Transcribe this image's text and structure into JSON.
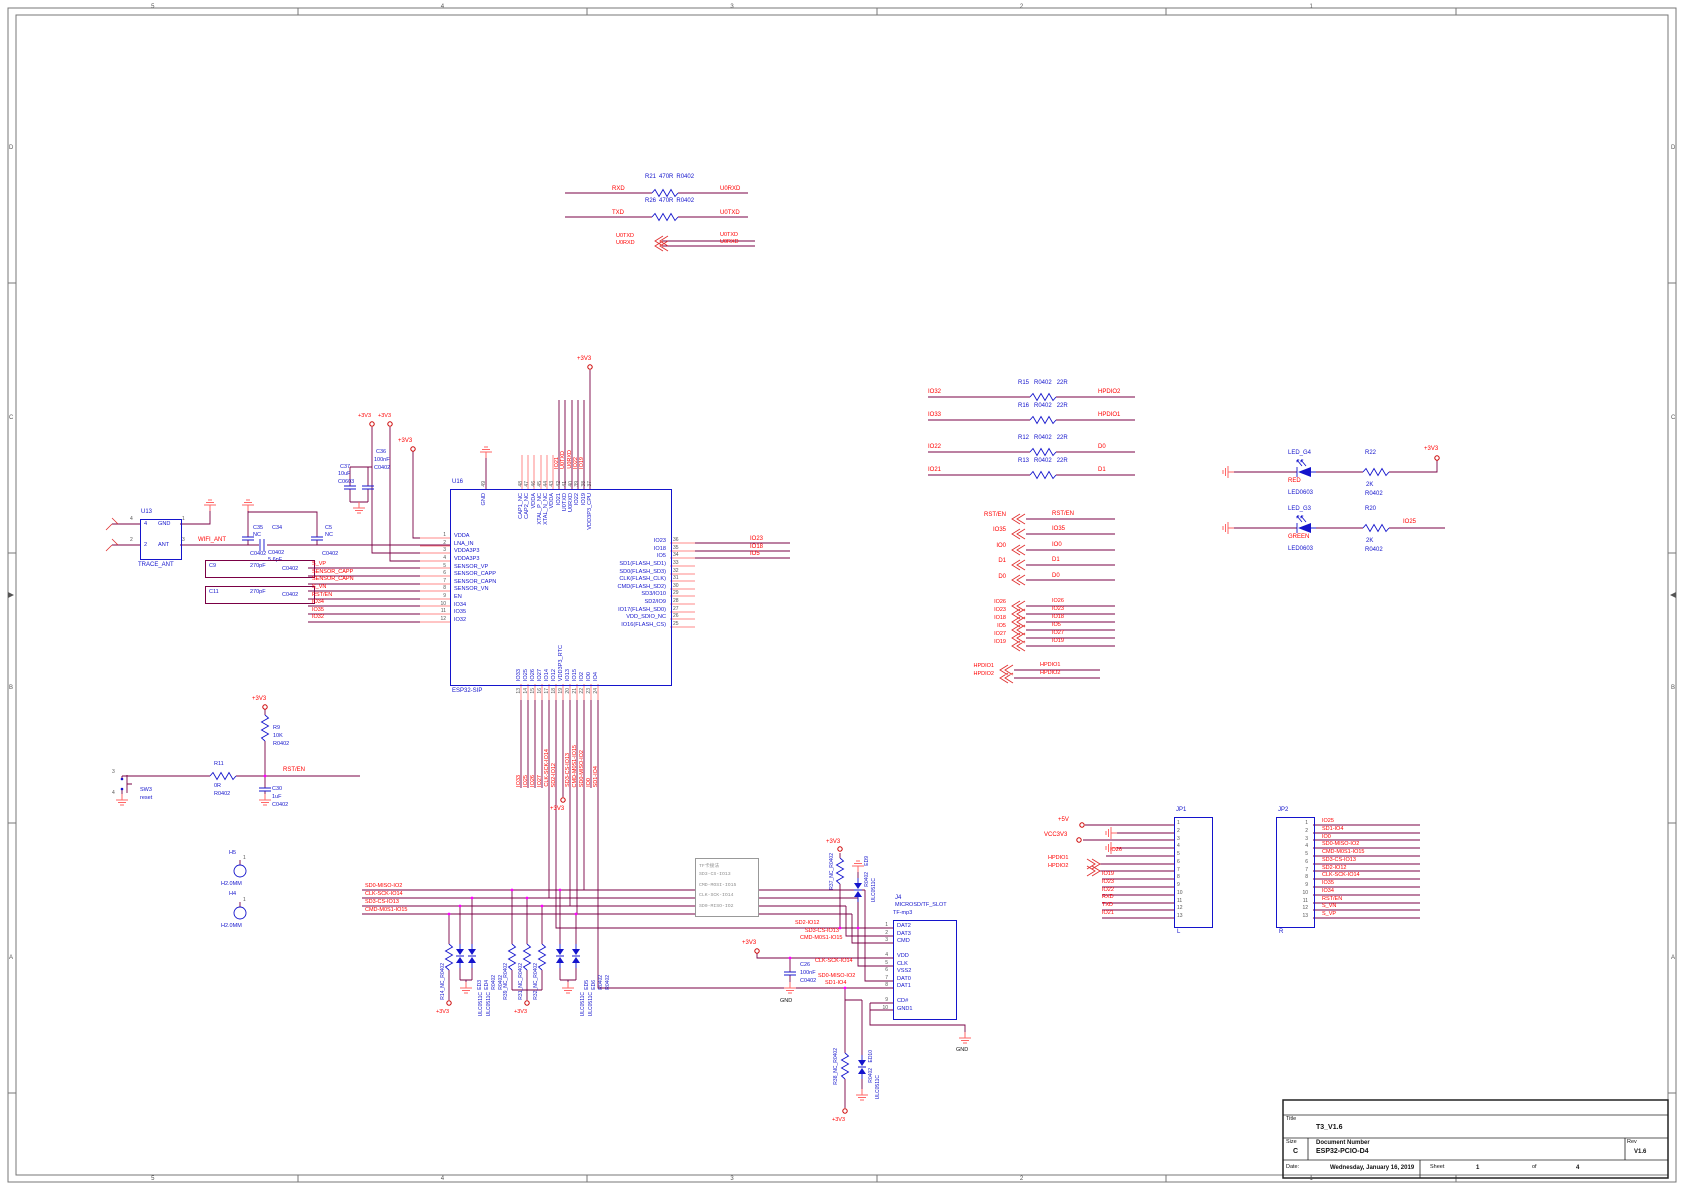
{
  "colors": {
    "wire": "#7a0045",
    "stub": "#ff8a8a",
    "net": "#ff0000",
    "component": "#1414cc",
    "junction": "#ff00ff",
    "note_gray": "#909090"
  },
  "frame": {
    "cols": [
      "5",
      "4",
      "3",
      "2",
      "1"
    ],
    "rows": [
      "D",
      "C",
      "B",
      "A"
    ]
  },
  "title_block": {
    "title_label": "Title",
    "title": "T3_V1.6",
    "size_label": "Size",
    "size": "C",
    "doc_label": "Document Number",
    "doc": "ESP32-PCIO-D4",
    "rev_label": "Rev",
    "rev": "V1.6",
    "date_label": "Date:",
    "date": "Wednesday, January 16, 2019",
    "sheet_label": "Sheet",
    "sheet_num": "1",
    "of_label": "of",
    "sheet_total": "4"
  },
  "power": {
    "p3v3": "+3V3",
    "p5v": "+5V",
    "vcc3v3": "VCC3V3",
    "gnd": "GND"
  },
  "uart": {
    "rows": [
      {
        "left": "RXD",
        "ref": "R21",
        "val": "470R",
        "fp": "R0402",
        "right": "U0RXD"
      },
      {
        "left": "TXD",
        "ref": "R26",
        "val": "470R",
        "fp": "R0402",
        "right": "U0TXD"
      }
    ],
    "bus_left": [
      "U0TXD",
      "U0RXD"
    ],
    "bus_right": [
      "U0TXD",
      "U0RXD"
    ]
  },
  "antenna": {
    "ref": "U13",
    "part": "TRACE_ANT",
    "net": "WIFI_ANT",
    "pins": {
      "gnd_name": "GND",
      "ant_name": "ANT",
      "n4": "4",
      "n1": "1",
      "n2": "2",
      "n3": "3"
    },
    "c35": {
      "ref": "C35",
      "val": "NC",
      "fp": "C0402"
    },
    "c34": {
      "ref": "C34",
      "val": "5.6pF",
      "fp": "C0402"
    },
    "c5": {
      "ref": "C5",
      "val": "NC",
      "fp": "C0402"
    },
    "c37": {
      "ref": "C37",
      "val": "10uF",
      "fp": "C0603"
    },
    "c36": {
      "ref": "C36",
      "val": "100nF",
      "fp": "C0402"
    },
    "c9": {
      "ref": "C9",
      "val": "270pF",
      "fp": "C0402"
    },
    "c11": {
      "ref": "C11",
      "val": "270pF",
      "fp": "C0402"
    }
  },
  "esp32": {
    "ref": "U16",
    "part": "ESP32-SIP",
    "left_pins": [
      {
        "n": "1",
        "name": "VDDA"
      },
      {
        "n": "2",
        "name": "LNA_IN"
      },
      {
        "n": "3",
        "name": "VDDA3P3"
      },
      {
        "n": "4",
        "name": "VDDA3P3"
      },
      {
        "n": "5",
        "name": "SENSOR_VP"
      },
      {
        "n": "6",
        "name": "SENSOR_CAPP"
      },
      {
        "n": "7",
        "name": "SENSOR_CAPN"
      },
      {
        "n": "8",
        "name": "SENSOR_VN"
      },
      {
        "n": "9",
        "name": "EN"
      },
      {
        "n": "10",
        "name": "IO34"
      },
      {
        "n": "11",
        "name": "IO35"
      },
      {
        "n": "12",
        "name": "IO32"
      }
    ],
    "gnd_pin": {
      "n": "49",
      "name": "GND"
    },
    "top_pins": [
      {
        "n": "48",
        "name": "CAP1_NC"
      },
      {
        "n": "47",
        "name": "CAP2_NC"
      },
      {
        "n": "46",
        "name": "VDDA"
      },
      {
        "n": "45",
        "name": "XTAL_P_NC"
      },
      {
        "n": "44",
        "name": "XTAL_N_NC"
      },
      {
        "n": "43",
        "name": "VDDA"
      },
      {
        "n": "42",
        "name": "IO21"
      },
      {
        "n": "41",
        "name": "U0TXD"
      },
      {
        "n": "40",
        "name": "U0RXD"
      },
      {
        "n": "39",
        "name": "IO22"
      },
      {
        "n": "38",
        "name": "IO19"
      },
      {
        "n": "37",
        "name": "VDD3P3_CPU"
      }
    ],
    "right_pins": [
      {
        "n": "36",
        "name": "IO23"
      },
      {
        "n": "35",
        "name": "IO18"
      },
      {
        "n": "34",
        "name": "IO5"
      },
      {
        "n": "33",
        "name": "SD1(FLASH_SD1)"
      },
      {
        "n": "32",
        "name": "SD0(FLASH_SD3)"
      },
      {
        "n": "31",
        "name": "CLK(FLASH_CLK)"
      },
      {
        "n": "30",
        "name": "CMD(FLASH_SD2)"
      },
      {
        "n": "29",
        "name": "SD3/IO10"
      },
      {
        "n": "28",
        "name": "SD2/IO9"
      },
      {
        "n": "27",
        "name": "IO17(FLASH_SD0)"
      },
      {
        "n": "26",
        "name": "VDD_SDIO_NC"
      },
      {
        "n": "25",
        "name": "IO16(FLASH_CS)"
      }
    ],
    "bottom_pins": [
      {
        "n": "13",
        "name": "IO33"
      },
      {
        "n": "14",
        "name": "IO25"
      },
      {
        "n": "15",
        "name": "IO26"
      },
      {
        "n": "16",
        "name": "IO27"
      },
      {
        "n": "17",
        "name": "IO14"
      },
      {
        "n": "18",
        "name": "IO12"
      },
      {
        "n": "19",
        "name": "VDD3P3_RTC"
      },
      {
        "n": "20",
        "name": "IO13"
      },
      {
        "n": "21",
        "name": "IO15"
      },
      {
        "n": "22",
        "name": "IO2"
      },
      {
        "n": "23",
        "name": "IO0"
      },
      {
        "n": "24",
        "name": "IO4"
      }
    ],
    "right_nets": [
      "IO23",
      "IO18",
      "IO5"
    ],
    "top_nets": [
      "IO21",
      "U0TXD",
      "U0RXD",
      "IO22",
      "IO19"
    ],
    "bottom_nets_a": [
      "IO33",
      "IO25",
      "IO26",
      "IO27",
      "CLK-SCK-IO14",
      "SD2-IO12"
    ],
    "bottom_nets_b": [
      "SD3-CS-IO13",
      "CMD-M0S1-IO15",
      "SD0-MISO-IO2",
      "IO0",
      "SD1-IO4"
    ],
    "sensor_nets": [
      "S_VP",
      "SENSOR_CAPP",
      "SENSOR_CAPN",
      "S_VN",
      "RST/EN",
      "IO34",
      "IO35",
      "IO32"
    ]
  },
  "reset": {
    "r9": {
      "ref": "R9",
      "val": "10K",
      "fp": "R0402"
    },
    "r11": {
      "ref": "R11",
      "val": "0R",
      "fp": "R0402"
    },
    "c30": {
      "ref": "C30",
      "val": "1uF",
      "fp": "C0402"
    },
    "sw": {
      "ref": "SW3",
      "val": "reset",
      "p3": "3",
      "p4": "4"
    },
    "net": "RST/EN"
  },
  "mount": {
    "h5": {
      "ref": "H5",
      "val": "H2.0MM",
      "pin": "1"
    },
    "h4": {
      "ref": "H4",
      "val": "H2.0MM",
      "pin": "1"
    }
  },
  "series_res": [
    {
      "left": "IO32",
      "ref": "R15",
      "fp": "R0402",
      "val": "22R",
      "right": "HPDIO2"
    },
    {
      "left": "IO33",
      "ref": "R16",
      "fp": "R0402",
      "val": "22R",
      "right": "HPDIO1"
    },
    {
      "left": "IO22",
      "ref": "R12",
      "fp": "R0402",
      "val": "22R",
      "right": "D0"
    },
    {
      "left": "IO21",
      "ref": "R13",
      "fp": "R0402",
      "val": "22R",
      "right": "D1"
    }
  ],
  "stubs_a_l": [
    "RST/EN",
    "IO35",
    "IO0",
    "D1",
    "D0"
  ],
  "stubs_a_r": [
    "RST/EN",
    "IO35",
    "IO0",
    "D1",
    "D0"
  ],
  "stubs_b_l": [
    "IO26",
    "IO23",
    "IO18",
    "IO5",
    "IO27",
    "IO19"
  ],
  "stubs_b_r": [
    "IO26",
    "IO23",
    "IO18",
    "IO5",
    "IO27",
    "IO19"
  ],
  "stubs_c_l": [
    "HPDIO1",
    "HPDIO2"
  ],
  "stubs_c_r": [
    "HPDIO1",
    "HPDIO2"
  ],
  "leds": [
    {
      "ref": "LED_G4",
      "color_name": "RED",
      "fp": "LED0603",
      "res_ref": "R22",
      "res_val": "2K",
      "res_fp": "R0402",
      "net": "+3V3"
    },
    {
      "ref": "LED_G3",
      "color_name": "GREEN",
      "fp": "LED0603",
      "res_ref": "R20",
      "res_val": "2K",
      "res_fp": "R0402",
      "net": "IO25"
    }
  ],
  "jp1": {
    "ref": "JP1",
    "side": "L",
    "pins": [
      "1",
      "2",
      "3",
      "4",
      "5",
      "6",
      "7",
      "8",
      "9",
      "10",
      "11",
      "12",
      "13"
    ],
    "net_p5v": "+5V",
    "net_vcc": "VCC3V3",
    "net_io26": "IO26",
    "bus": [
      "HPDIO1",
      "HPDIO2"
    ],
    "nets": [
      "IO19",
      "IO23",
      "IO22",
      "RXD",
      "TXD",
      "IO21"
    ]
  },
  "jp2": {
    "ref": "JP2",
    "side": "R",
    "pins": [
      "1",
      "2",
      "3",
      "4",
      "5",
      "6",
      "7",
      "8",
      "9",
      "10",
      "11",
      "12",
      "13"
    ],
    "nets": [
      "IO25",
      "SD1-IO4",
      "IO0",
      "SD0-MISO-IO2",
      "CMD-M0S1-IO15",
      "SD3-CS-IO13",
      "SD2-IO12",
      "CLK-SCK-IO14",
      "IO35",
      "IO34",
      "RST/EN",
      "S_VN",
      "S_VP"
    ]
  },
  "sd_bus": [
    "SD0-MISO-IO2",
    "CLK-SCK-IO14",
    "SD3-CS-IO13",
    "CMD-M0S1-IO15"
  ],
  "note": {
    "lines": [
      "TF卡接法",
      "SD3-CS-IO13",
      "CMD-MOSI-IO15",
      "CLK-SCK-IO14",
      "SD0-MISO-IO2"
    ]
  },
  "microsd": {
    "ref": "J4",
    "part": "MICROSD/TF_SLOT",
    "val": "TF-mp3",
    "pins_a": [
      {
        "n": "1",
        "name": "DAT2"
      },
      {
        "n": "2",
        "name": "DAT3"
      },
      {
        "n": "3",
        "name": "CMD"
      }
    ],
    "pins_b": [
      {
        "n": "4",
        "name": "VDD"
      },
      {
        "n": "5",
        "name": "CLK"
      },
      {
        "n": "6",
        "name": "VSS2"
      },
      {
        "n": "7",
        "name": "DAT0"
      },
      {
        "n": "8",
        "name": "DAT1"
      }
    ],
    "pins_c": [
      {
        "n": "9",
        "name": "CD#"
      },
      {
        "n": "10",
        "name": "GND1"
      }
    ],
    "nets": {
      "p1": "SD2-IO12",
      "p2": "SD3-CS-IO13",
      "p3": "CMD-M0S1-IO15",
      "p5": "CLK-SCK-IO14",
      "p7": "SD0-MISO-IO2",
      "p8": "SD1-IO4"
    },
    "c26": {
      "ref": "C26",
      "val": "100nF",
      "fp": "C0402"
    },
    "top_prot": {
      "r": "R37_NC_R0402",
      "ed": "ED9",
      "fp": "R0402",
      "type": "ULC0511C"
    },
    "bot_prot": {
      "r": "R38_NC_R0402",
      "ed": "ED10",
      "fp": "R0402",
      "type": "ULC0511C"
    }
  },
  "esd": {
    "g1": {
      "r1": "R14_NC_R0402",
      "r2": "R39_NC_R0402",
      "d1": "ED3",
      "d2": "ED4",
      "fp1": "R0402",
      "fp2": "R0402",
      "t1": "ULC0511C",
      "t2": "ULC0511C"
    },
    "g2": {
      "r1": "R31_NC_R0402",
      "r2": "R32_NC_R0402",
      "d1": "ED5",
      "d2": "ED6",
      "fp1": "R0402",
      "fp2": "R0402",
      "t1": "ULC0511C",
      "t2": "ULC0511C"
    }
  }
}
